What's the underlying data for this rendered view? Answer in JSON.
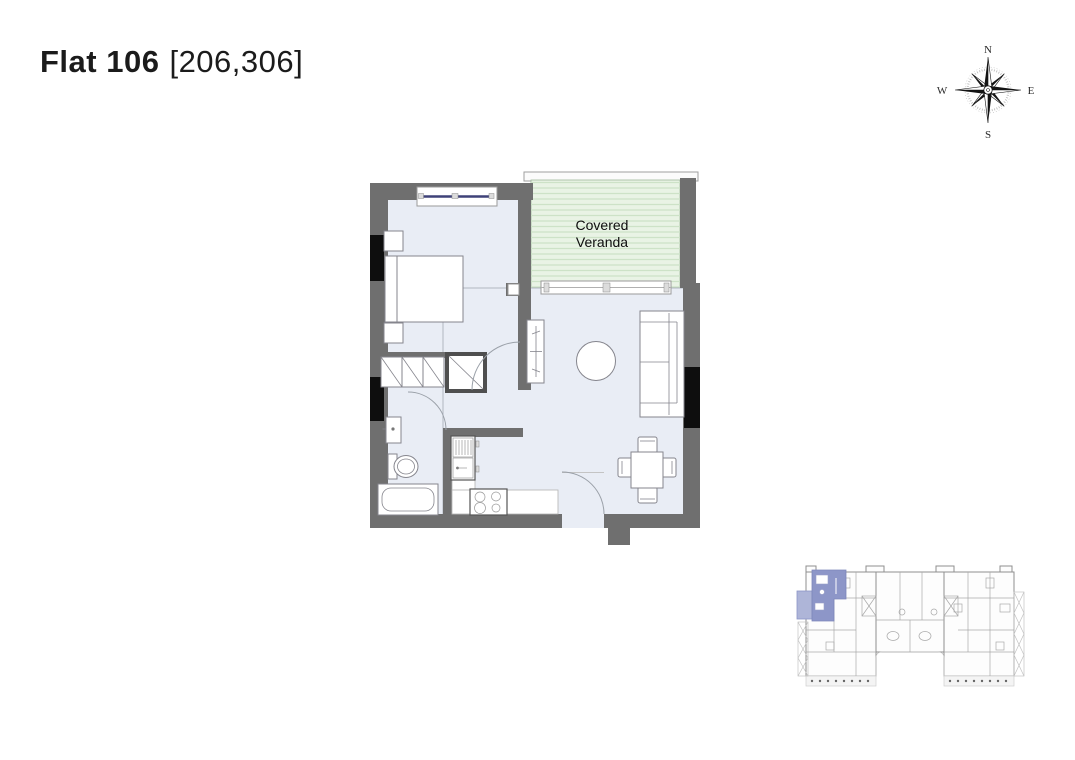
{
  "header": {
    "flat_name": "Flat 106",
    "unit_numbers": "[206,306]"
  },
  "floor_plan": {
    "veranda": {
      "line1": "Covered",
      "line2": "Veranda"
    }
  },
  "compass": {
    "n": "N",
    "e": "E",
    "s": "S",
    "w": "W"
  },
  "colors": {
    "ink": "#1b1b1b",
    "wall": "#6f6f6f",
    "wallblk": "#0e0e0e",
    "floor": "#e9edf5",
    "veranda": "#e9f3e5",
    "veranda_stripe": "#cde2c7",
    "window_accent": "#3f4278",
    "furn": "#85858d",
    "arc": "#9aa0a8",
    "highlight": "#8d96c8",
    "highlight_light": "#aeb5d8",
    "kp_line": "#a9a9a9"
  }
}
